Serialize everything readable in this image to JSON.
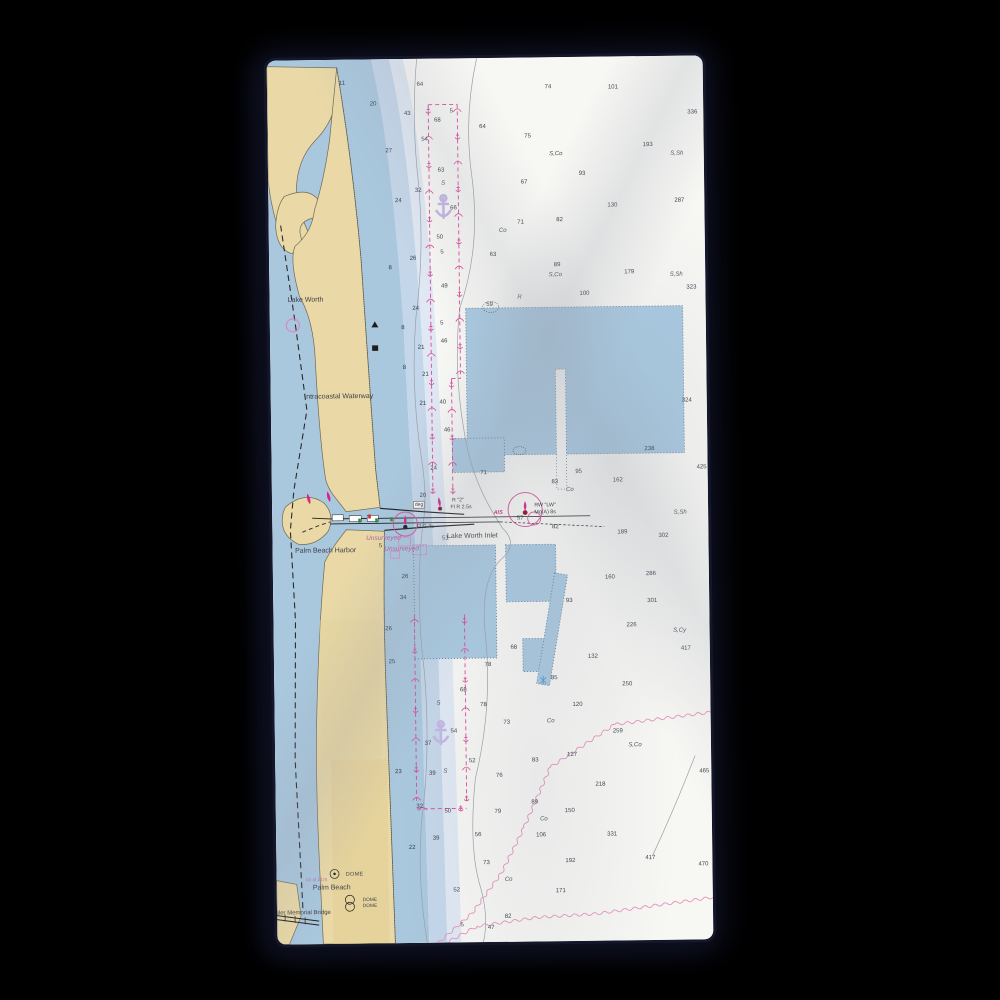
{
  "scene": {
    "product_type": "nautical chart beach towel product photo",
    "background_color": "#000000",
    "towel_fabric_color": "#f6f6f3"
  },
  "chart": {
    "region": "Lake Worth Inlet / Palm Beach Harbor, Florida",
    "colors": {
      "water_shallow": "#a9c7dd",
      "water_band_mid": "#c4d6e9",
      "water_band_light": "#dfe8f3",
      "land_tan": "#ead9a6",
      "spoil_area_blue": "#a9c9e0",
      "magenta_aid": "#d84a9b",
      "anchor_purple": "#c3b5e4",
      "contour_gray": "#9aa0a8",
      "sounding_text": "#39424e"
    },
    "labels": [
      {
        "text": "Lake Worth",
        "x": 36,
        "y": 240,
        "cls": "place"
      },
      {
        "text": "Intracoastal Waterway",
        "x": 68,
        "y": 337,
        "cls": "place"
      },
      {
        "text": "Palm Beach Harbor",
        "x": 53,
        "y": 491,
        "cls": "place"
      },
      {
        "text": "Lake Worth Inlet",
        "x": 200,
        "y": 478,
        "cls": "place"
      },
      {
        "text": "Palm Beach",
        "x": 55,
        "y": 828,
        "cls": "place"
      },
      {
        "text": "Flagler Memorial Bridge",
        "x": 22,
        "y": 853,
        "cls": "place-sm"
      },
      {
        "text": "Unsurveyed",
        "x": 111,
        "y": 479,
        "cls": "unsurveyed"
      },
      {
        "text": "Unsurveyed",
        "x": 129,
        "y": 490,
        "cls": "unsurveyed"
      },
      {
        "text": "DOME",
        "x": 78,
        "y": 815,
        "cls": "note"
      },
      {
        "text": "DOME",
        "x": 93,
        "y": 841,
        "cls": "note-xs"
      },
      {
        "text": "DOME",
        "x": 93,
        "y": 847,
        "cls": "note-xs"
      },
      {
        "text": "cir cl 21m",
        "x": 40,
        "y": 820,
        "cls": "note-mag"
      }
    ],
    "nav_aids": [
      {
        "text": "R \"2\"",
        "x": 186,
        "y": 442,
        "cls": "aid"
      },
      {
        "text": "Fl R 2.5s",
        "x": 189,
        "y": 449,
        "cls": "aid"
      },
      {
        "text": "Fl G 4s",
        "x": 153,
        "y": 468,
        "cls": "aid"
      },
      {
        "text": "RW \"LW\"",
        "x": 273,
        "y": 448,
        "cls": "aid"
      },
      {
        "text": "Mo(A) 8s",
        "x": 273,
        "y": 455,
        "cls": "aid"
      },
      {
        "text": "AIS",
        "x": 226,
        "y": 455,
        "cls": "aid-mag"
      },
      {
        "text": "deg",
        "x": 147,
        "y": 446,
        "cls": "aid-box"
      }
    ],
    "soundings": [
      {
        "x": 75,
        "y": 24,
        "v": "11"
      },
      {
        "x": 106,
        "y": 45,
        "v": "20"
      },
      {
        "x": 140,
        "y": 55,
        "v": "43"
      },
      {
        "x": 153,
        "y": 26,
        "v": "64"
      },
      {
        "x": 170,
        "y": 62,
        "v": "68"
      },
      {
        "x": 184,
        "y": 53,
        "v": "5"
      },
      {
        "x": 215,
        "y": 69,
        "v": "64"
      },
      {
        "x": 157,
        "y": 81,
        "v": "54"
      },
      {
        "x": 121,
        "y": 92,
        "v": "27"
      },
      {
        "x": 281,
        "y": 30,
        "v": "74"
      },
      {
        "x": 346,
        "y": 31,
        "v": "101"
      },
      {
        "x": 425,
        "y": 57,
        "v": "336"
      },
      {
        "x": 260,
        "y": 79,
        "v": "75"
      },
      {
        "x": 288,
        "y": 97,
        "v": "S,Co"
      },
      {
        "x": 380,
        "y": 89,
        "v": "193"
      },
      {
        "x": 409,
        "y": 98,
        "v": "S,Sh"
      },
      {
        "x": 314,
        "y": 117,
        "v": "93"
      },
      {
        "x": 256,
        "y": 125,
        "v": "67"
      },
      {
        "x": 344,
        "y": 149,
        "v": "130"
      },
      {
        "x": 411,
        "y": 145,
        "v": "287"
      },
      {
        "x": 252,
        "y": 165,
        "v": "71"
      },
      {
        "x": 291,
        "y": 163,
        "v": "82"
      },
      {
        "x": 234,
        "y": 173,
        "v": "Co"
      },
      {
        "x": 224,
        "y": 197,
        "v": "63"
      },
      {
        "x": 288,
        "y": 208,
        "v": "89"
      },
      {
        "x": 286,
        "y": 218,
        "v": "S,Co"
      },
      {
        "x": 360,
        "y": 216,
        "v": "179"
      },
      {
        "x": 407,
        "y": 219,
        "v": "S,Sh"
      },
      {
        "x": 422,
        "y": 232,
        "v": "323"
      },
      {
        "x": 315,
        "y": 237,
        "v": "100"
      },
      {
        "x": 250,
        "y": 240,
        "v": "R"
      },
      {
        "x": 175,
        "y": 228,
        "v": "49"
      },
      {
        "x": 130,
        "y": 142,
        "v": "24"
      },
      {
        "x": 150,
        "y": 132,
        "v": "32"
      },
      {
        "x": 173,
        "y": 112,
        "v": "63"
      },
      {
        "x": 175,
        "y": 125,
        "v": "S"
      },
      {
        "x": 171,
        "y": 179,
        "v": "50"
      },
      {
        "x": 173,
        "y": 194,
        "v": "5"
      },
      {
        "x": 144,
        "y": 200,
        "v": "26"
      },
      {
        "x": 121,
        "y": 209,
        "v": "8"
      },
      {
        "x": 185,
        "y": 150,
        "v": "66"
      },
      {
        "x": 146,
        "y": 250,
        "v": "24"
      },
      {
        "x": 172,
        "y": 265,
        "v": "5"
      },
      {
        "x": 174,
        "y": 283,
        "v": "46"
      },
      {
        "x": 151,
        "y": 289,
        "v": "21"
      },
      {
        "x": 134,
        "y": 309,
        "v": "8"
      },
      {
        "x": 155,
        "y": 316,
        "v": "21"
      },
      {
        "x": 152,
        "y": 345,
        "v": "21"
      },
      {
        "x": 172,
        "y": 344,
        "v": "40"
      },
      {
        "x": 176,
        "y": 372,
        "v": "46"
      },
      {
        "x": 162,
        "y": 410,
        "v": "24"
      },
      {
        "x": 212,
        "y": 415,
        "v": "71"
      },
      {
        "x": 151,
        "y": 437,
        "v": "20"
      },
      {
        "x": 133,
        "y": 269,
        "v": "8"
      },
      {
        "x": 378,
        "y": 393,
        "v": "238"
      },
      {
        "x": 416,
        "y": 345,
        "v": "324"
      },
      {
        "x": 430,
        "y": 412,
        "v": "425"
      },
      {
        "x": 307,
        "y": 415,
        "v": "95"
      },
      {
        "x": 346,
        "y": 424,
        "v": "162"
      },
      {
        "x": 298,
        "y": 433,
        "v": "Co"
      },
      {
        "x": 283,
        "y": 425,
        "v": "83"
      },
      {
        "x": 220,
        "y": 247,
        "v": "59"
      },
      {
        "x": 248,
        "y": 461,
        "v": "57"
      },
      {
        "x": 283,
        "y": 470,
        "v": "82"
      },
      {
        "x": 173,
        "y": 480,
        "v": "51"
      },
      {
        "x": 108,
        "y": 487,
        "v": "5"
      },
      {
        "x": 132,
        "y": 518,
        "v": "26"
      },
      {
        "x": 130,
        "y": 539,
        "v": "34"
      },
      {
        "x": 115,
        "y": 570,
        "v": "26"
      },
      {
        "x": 118,
        "y": 603,
        "v": "25"
      },
      {
        "x": 296,
        "y": 544,
        "v": "93"
      },
      {
        "x": 337,
        "y": 521,
        "v": "160"
      },
      {
        "x": 378,
        "y": 518,
        "v": "286"
      },
      {
        "x": 391,
        "y": 480,
        "v": "302"
      },
      {
        "x": 350,
        "y": 476,
        "v": "189"
      },
      {
        "x": 408,
        "y": 457,
        "v": "S,Sh"
      },
      {
        "x": 379,
        "y": 545,
        "v": "301"
      },
      {
        "x": 358,
        "y": 569,
        "v": "226"
      },
      {
        "x": 406,
        "y": 575,
        "v": "S,Cy"
      },
      {
        "x": 412,
        "y": 593,
        "v": "417"
      },
      {
        "x": 319,
        "y": 600,
        "v": "132"
      },
      {
        "x": 280,
        "y": 621,
        "v": "85"
      },
      {
        "x": 240,
        "y": 590,
        "v": "68"
      },
      {
        "x": 214,
        "y": 607,
        "v": "78"
      },
      {
        "x": 353,
        "y": 628,
        "v": "250"
      },
      {
        "x": 189,
        "y": 632,
        "v": "68"
      },
      {
        "x": 164,
        "y": 645,
        "v": "S"
      },
      {
        "x": 209,
        "y": 647,
        "v": "78"
      },
      {
        "x": 179,
        "y": 673,
        "v": "54"
      },
      {
        "x": 153,
        "y": 685,
        "v": "37"
      },
      {
        "x": 197,
        "y": 703,
        "v": "52"
      },
      {
        "x": 123,
        "y": 713,
        "v": "23"
      },
      {
        "x": 157,
        "y": 715,
        "v": "39"
      },
      {
        "x": 170,
        "y": 713,
        "v": "S"
      },
      {
        "x": 224,
        "y": 718,
        "v": "76"
      },
      {
        "x": 144,
        "y": 748,
        "v": "32"
      },
      {
        "x": 172,
        "y": 753,
        "v": "50"
      },
      {
        "x": 202,
        "y": 777,
        "v": "56"
      },
      {
        "x": 136,
        "y": 789,
        "v": "22"
      },
      {
        "x": 160,
        "y": 780,
        "v": "39"
      },
      {
        "x": 222,
        "y": 754,
        "v": "79"
      },
      {
        "x": 259,
        "y": 745,
        "v": "89"
      },
      {
        "x": 294,
        "y": 754,
        "v": "150"
      },
      {
        "x": 268,
        "y": 762,
        "v": "Co"
      },
      {
        "x": 265,
        "y": 778,
        "v": "106"
      },
      {
        "x": 336,
        "y": 778,
        "v": "331"
      },
      {
        "x": 303,
        "y": 648,
        "v": "120"
      },
      {
        "x": 232,
        "y": 665,
        "v": "73"
      },
      {
        "x": 276,
        "y": 664,
        "v": "Co"
      },
      {
        "x": 343,
        "y": 675,
        "v": "259"
      },
      {
        "x": 360,
        "y": 689,
        "v": "S,Co"
      },
      {
        "x": 297,
        "y": 698,
        "v": "127"
      },
      {
        "x": 260,
        "y": 703,
        "v": "83"
      },
      {
        "x": 325,
        "y": 728,
        "v": "218"
      },
      {
        "x": 429,
        "y": 716,
        "v": "465"
      },
      {
        "x": 294,
        "y": 804,
        "v": "192"
      },
      {
        "x": 374,
        "y": 802,
        "v": "417"
      },
      {
        "x": 427,
        "y": 809,
        "v": "470"
      },
      {
        "x": 232,
        "y": 822,
        "v": "Co"
      },
      {
        "x": 284,
        "y": 834,
        "v": "171"
      },
      {
        "x": 231,
        "y": 859,
        "v": "82"
      },
      {
        "x": 210,
        "y": 805,
        "v": "73"
      },
      {
        "x": 180,
        "y": 832,
        "v": "52"
      },
      {
        "x": 185,
        "y": 867,
        "v": "5"
      },
      {
        "x": 214,
        "y": 870,
        "v": "47"
      }
    ]
  }
}
